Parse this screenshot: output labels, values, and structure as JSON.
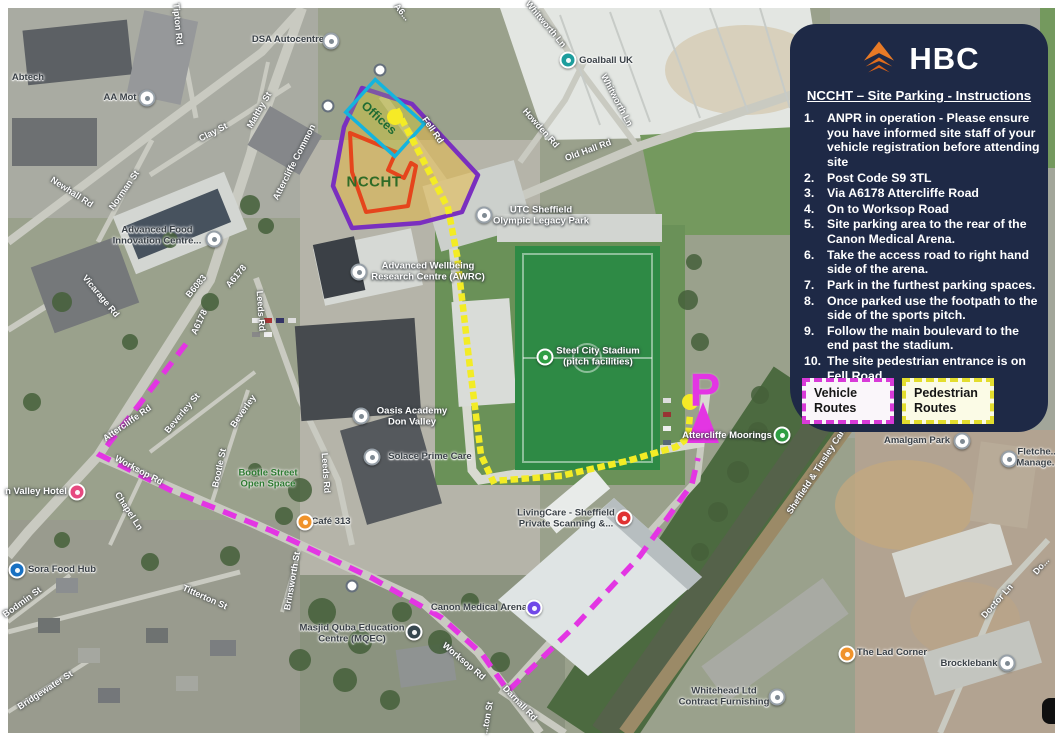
{
  "panel": {
    "logo": {
      "text": "HBC",
      "icon": "hbc-chevron-logo",
      "color": "#e87a26"
    },
    "title": "NCCHT – Site Parking - Instructions",
    "instructions": [
      "ANPR in operation - Please ensure you have informed site staff of your vehicle registration before attending site",
      "Post Code S9 3TL",
      "Via A6178 Attercliffe Road",
      "On to Worksop Road",
      "Site parking area to the rear of the Canon Medical Arena.",
      "Take the access road to right hand side of the arena.",
      "Park in the furthest parking spaces.",
      "Once parked use the footpath to the side of the sports pitch.",
      "Follow the main boulevard to the end past the stadium.",
      "The site pedestrian entrance is on Fell Road."
    ],
    "legend": [
      {
        "label": "Vehicle Routes",
        "color": "#d83ad8",
        "style": "dashed"
      },
      {
        "label": "Pedestrian Routes",
        "color": "#e3dd2e",
        "style": "dotted"
      }
    ],
    "bg": "#1e2946"
  },
  "map": {
    "site_label": "NCCHT",
    "offices_label": "Offices",
    "parking_letter": "P",
    "colors": {
      "vehicle_route": "#e335e3",
      "pedestrian_route": "#f3ec25",
      "site_outline": "#7a2fbf",
      "building_outline": "#e5451c",
      "offices_outline": "#14b4de",
      "route_start_dot": "#f6ea26"
    },
    "road_labels": [
      {
        "text": "Tipton Rd",
        "x": 178,
        "y": 24,
        "r": 85
      },
      {
        "text": "A6...",
        "x": 402,
        "y": 12,
        "r": 50
      },
      {
        "text": "Whitworth Ln",
        "x": 546,
        "y": 24,
        "r": 50
      },
      {
        "text": "Whitworth Ln",
        "x": 617,
        "y": 100,
        "r": 62
      },
      {
        "text": "Howden Rd",
        "x": 541,
        "y": 128,
        "r": 48
      },
      {
        "text": "Old Hall Rd",
        "x": 588,
        "y": 150,
        "r": -20
      },
      {
        "text": "Clay St",
        "x": 213,
        "y": 132,
        "r": -27
      },
      {
        "text": "Maltby St",
        "x": 259,
        "y": 110,
        "r": -60
      },
      {
        "text": "Attercliffe Common",
        "x": 294,
        "y": 162,
        "r": -63
      },
      {
        "text": "Newhall Rd",
        "x": 72,
        "y": 192,
        "r": 33
      },
      {
        "text": "Norman St",
        "x": 124,
        "y": 190,
        "r": -55
      },
      {
        "text": "Vicarage Rd",
        "x": 101,
        "y": 296,
        "r": 50
      },
      {
        "text": "B6083",
        "x": 196,
        "y": 286,
        "r": -50
      },
      {
        "text": "A6178",
        "x": 236,
        "y": 276,
        "r": -50
      },
      {
        "text": "A6178",
        "x": 199,
        "y": 322,
        "r": -65
      },
      {
        "text": "Leeds Rd",
        "x": 261,
        "y": 311,
        "r": 86
      },
      {
        "text": "Leeds Rd",
        "x": 326,
        "y": 473,
        "r": 86
      },
      {
        "text": "Fell Rd",
        "x": 433,
        "y": 130,
        "r": 55
      },
      {
        "text": "Attercliffe Rd",
        "x": 127,
        "y": 423,
        "r": -35
      },
      {
        "text": "Worksop Rd",
        "x": 139,
        "y": 470,
        "r": 28
      },
      {
        "text": "Worksop Rd",
        "x": 464,
        "y": 661,
        "r": 40
      },
      {
        "text": "Beverley St",
        "x": 182,
        "y": 413,
        "r": -50
      },
      {
        "text": "Beverley",
        "x": 243,
        "y": 411,
        "r": -55
      },
      {
        "text": "Bootle St",
        "x": 219,
        "y": 468,
        "r": -78
      },
      {
        "text": "Chapel Ln",
        "x": 129,
        "y": 511,
        "r": 57
      },
      {
        "text": "Titterton St",
        "x": 205,
        "y": 597,
        "r": 24
      },
      {
        "text": "Bodmin St",
        "x": 22,
        "y": 602,
        "r": -36
      },
      {
        "text": "Brinsworth St",
        "x": 292,
        "y": 581,
        "r": -80
      },
      {
        "text": "Bridgewater St",
        "x": 45,
        "y": 690,
        "r": -33
      },
      {
        "text": "Darnall Rd",
        "x": 520,
        "y": 703,
        "r": 46
      },
      {
        "text": "Doctor Ln",
        "x": 997,
        "y": 601,
        "r": -48
      },
      {
        "text": "Do...",
        "x": 1041,
        "y": 566,
        "r": -48
      },
      {
        "text": "Sheffield & Tinsley Canal",
        "x": 818,
        "y": 468,
        "r": -57
      },
      {
        "text": "...ton St",
        "x": 487,
        "y": 718,
        "r": -80
      }
    ],
    "poi_labels": [
      {
        "lines": [
          "Abtech"
        ],
        "x": 28,
        "y": 78,
        "v": "d",
        "dot": null,
        "dotColor": null
      },
      {
        "lines": [
          "AA Mot"
        ],
        "x": 120,
        "y": 98,
        "v": "d",
        "dot": [
          147,
          98
        ],
        "dotColor": "#ffffff"
      },
      {
        "lines": [
          "DSA Autocentre"
        ],
        "x": 288,
        "y": 40,
        "v": "d",
        "dot": [
          331,
          41
        ],
        "dotColor": "#ffffff"
      },
      {
        "lines": [
          "Goalball UK"
        ],
        "x": 606,
        "y": 61,
        "v": "d",
        "dot": [
          568,
          60
        ],
        "dotColor": "#1c9d9d"
      },
      {
        "lines": [
          "Advanced Food",
          "Innovation Centre..."
        ],
        "x": 157,
        "y": 236,
        "v": "d",
        "dot": [
          214,
          239
        ],
        "dotColor": "#ffffff"
      },
      {
        "lines": [
          "Advanced Wellbeing",
          "Research Centre (AWRC)"
        ],
        "x": 428,
        "y": 272,
        "v": "w",
        "dot": [
          359,
          272
        ],
        "dotColor": "#ffffff"
      },
      {
        "lines": [
          "UTC Sheffield",
          "Olympic Legacy Park"
        ],
        "x": 541,
        "y": 216,
        "v": "w",
        "dot": [
          484,
          215
        ],
        "dotColor": "#ffffff"
      },
      {
        "lines": [
          "Steel City Stadium",
          "(pitch facilities)"
        ],
        "x": 598,
        "y": 357,
        "v": "w",
        "dot": [
          545,
          357
        ],
        "dotColor": "#2f9e44"
      },
      {
        "lines": [
          "Oasis Academy",
          "Don Valley"
        ],
        "x": 412,
        "y": 417,
        "v": "w",
        "dot": [
          361,
          416
        ],
        "dotColor": "#ffffff"
      },
      {
        "lines": [
          "Solace Prime Care"
        ],
        "x": 430,
        "y": 457,
        "v": "d",
        "dot": [
          372,
          457
        ],
        "dotColor": "#ffffff"
      },
      {
        "lines": [
          "Café 313"
        ],
        "x": 331,
        "y": 522,
        "v": "d",
        "dot": [
          305,
          522
        ],
        "dotColor": "#f0932b"
      },
      {
        "lines": [
          "Attercliffe Moorings"
        ],
        "x": 727,
        "y": 436,
        "v": "w",
        "dot": [
          782,
          435
        ],
        "dotColor": "#2f9e44"
      },
      {
        "lines": [
          "LivingCare - Sheffield",
          "Private Scanning &..."
        ],
        "x": 566,
        "y": 519,
        "v": "d",
        "dot": [
          624,
          518
        ],
        "dotColor": "#e03131"
      },
      {
        "lines": [
          "Canon Medical Arena"
        ],
        "x": 479,
        "y": 608,
        "v": "d",
        "dot": [
          534,
          608
        ],
        "dotColor": "#7048e8"
      },
      {
        "lines": [
          "Masjid Quba Education",
          "Centre (MQEC)"
        ],
        "x": 352,
        "y": 634,
        "v": "d",
        "dot": [
          414,
          632
        ],
        "dotColor": "#37474f"
      },
      {
        "lines": [
          "Amalgam Park"
        ],
        "x": 917,
        "y": 441,
        "v": "d",
        "dot": [
          962,
          441
        ],
        "dotColor": "#ffffff"
      },
      {
        "lines": [
          "Fletche...",
          "Manage..."
        ],
        "x": 1038,
        "y": 458,
        "v": "d",
        "dot": [
          1009,
          459
        ],
        "dotColor": "#ffffff"
      },
      {
        "lines": [
          "The Lad Corner"
        ],
        "x": 892,
        "y": 653,
        "v": "d",
        "dot": [
          847,
          654
        ],
        "dotColor": "#f0932b"
      },
      {
        "lines": [
          "Brocklebank"
        ],
        "x": 969,
        "y": 664,
        "v": "d",
        "dot": [
          1007,
          663
        ],
        "dotColor": "#ffffff"
      },
      {
        "lines": [
          "Whitehead Ltd",
          "Contract Furnishing"
        ],
        "x": 724,
        "y": 697,
        "v": "d",
        "dot": [
          777,
          697
        ],
        "dotColor": "#ffffff"
      },
      {
        "lines": [
          "n Valley Hotel"
        ],
        "x": 36,
        "y": 492,
        "v": "w",
        "dot": [
          77,
          492
        ],
        "dotColor": "#e64980"
      },
      {
        "lines": [
          "Sora Food Hub"
        ],
        "x": 62,
        "y": 570,
        "v": "d",
        "dot": [
          17,
          570
        ],
        "dotColor": "#1971c2"
      },
      {
        "lines": [
          "Bootle Street",
          "Open Space"
        ],
        "x": 268,
        "y": 479,
        "v": "g",
        "dot": null,
        "dotColor": null
      }
    ],
    "bus_stops": [
      [
        380,
        70
      ],
      [
        328,
        106
      ],
      [
        352,
        586
      ]
    ]
  }
}
